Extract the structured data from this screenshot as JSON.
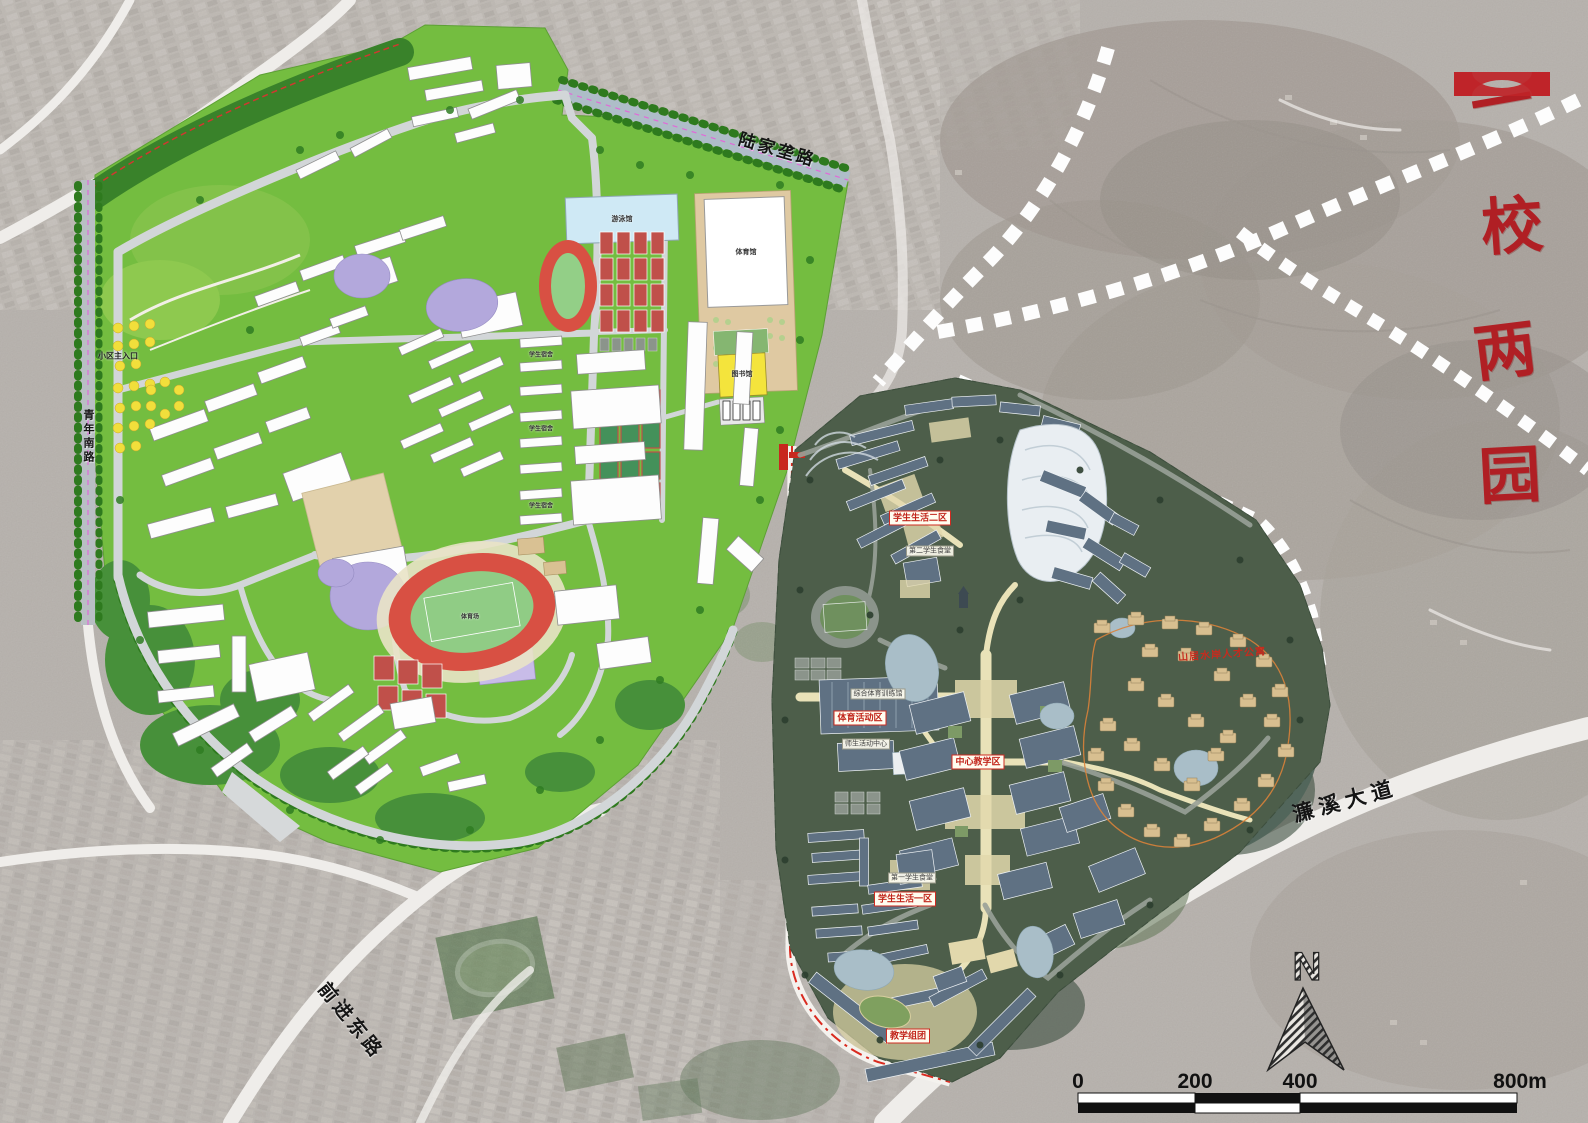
{
  "title": {
    "text": "一校两园",
    "chars": [
      "一",
      "校",
      "两",
      "园"
    ]
  },
  "compass": {
    "north_label": "N"
  },
  "scale_bar": {
    "ticks": [
      "0",
      "200",
      "400",
      "800m"
    ]
  },
  "roads": {
    "lianxi_avenue": "濂溪大道",
    "qianjin_east_road": "前进东路",
    "qingnian_south_road": "青年南路",
    "lujialong_road": "陆家垄路"
  },
  "left_campus": {
    "entrance_label": "小区主入口",
    "labels": {
      "gymnasium": "体育馆",
      "natatorium": "游泳馆",
      "library": "图书馆",
      "stadium": "体育场",
      "dormitory": "学生宿舍"
    }
  },
  "right_campus": {
    "zone_labels": {
      "central_teaching": "中心教学区",
      "student_life_2": "学生生活二区",
      "student_life_1": "学生生活一区",
      "sports_activity": "体育活动区",
      "teaching_cluster": "教学组团"
    },
    "building_labels": {
      "canteen_2": "第二学生食堂",
      "canteen_1": "第一学生食堂",
      "sports_training_hall": "综合体育训练馆",
      "activity_center": "师生活动中心"
    },
    "annotation": "山居水岸人才公寓"
  },
  "colors": {
    "title_red": "#b01f24",
    "boundary_red": "#e03026",
    "old_campus_green": "#74bd40",
    "new_campus_green": "#4d5e4a",
    "planned_road_white": "#fdfdfd"
  }
}
